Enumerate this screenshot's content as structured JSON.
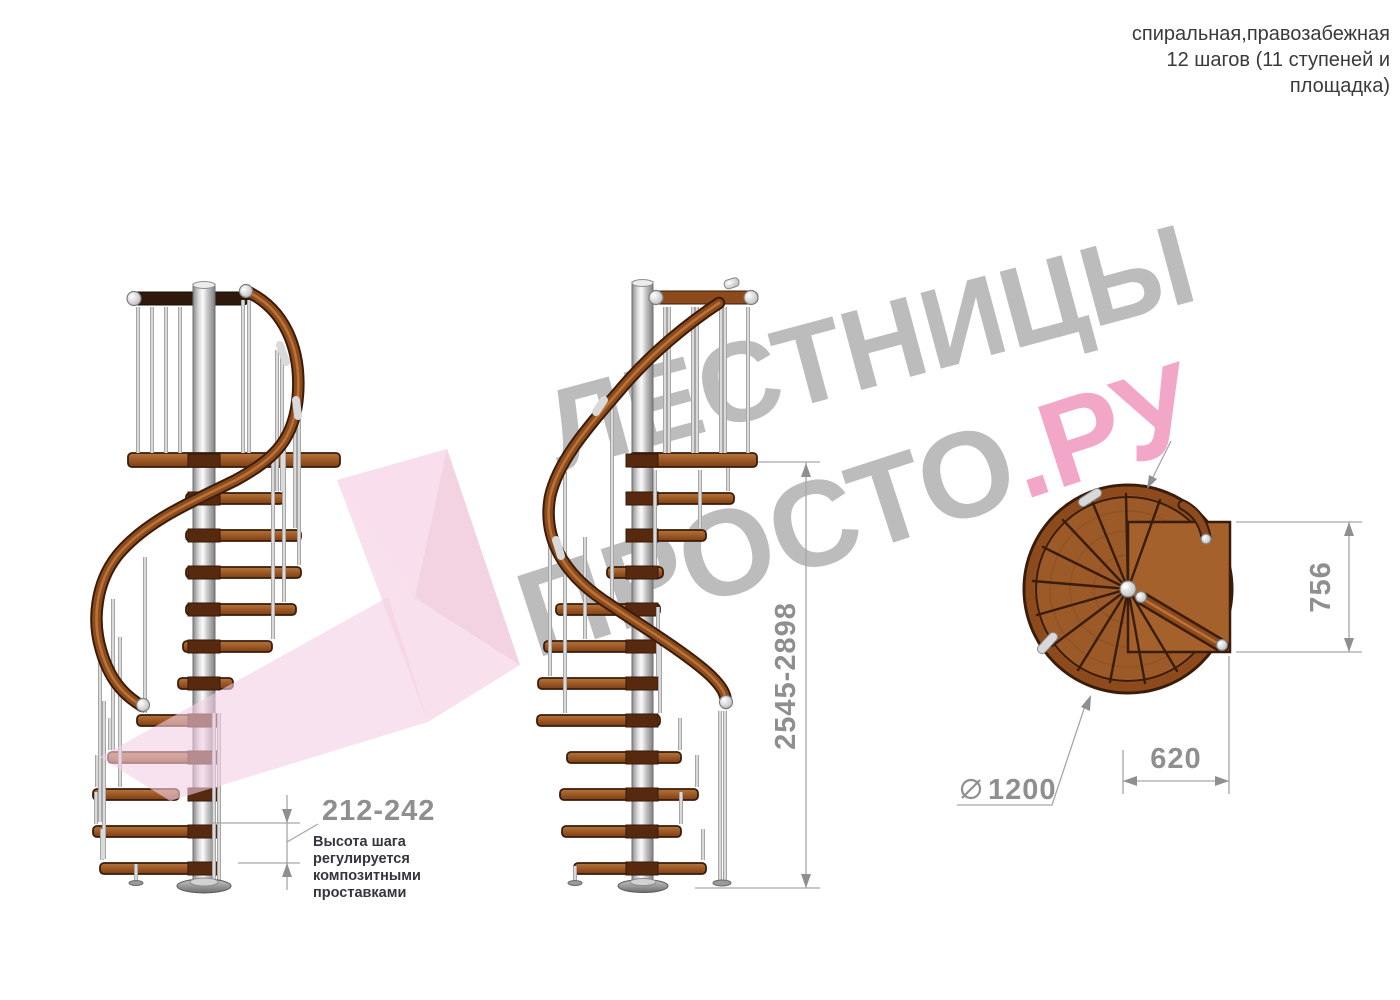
{
  "header": {
    "line1": "спиральная,правозабежная",
    "line2": "12 шагов (11 ступеней и",
    "line3": "площадка)"
  },
  "watermark": {
    "line1": "ЛЕСТНИЦЫ",
    "line2_gray": "ПРОСТО",
    "line2_pink": ".РУ"
  },
  "dimensions": {
    "step_height": {
      "value": "212-242",
      "note_line1": "Высота шага",
      "note_line2": "регулируется",
      "note_line3": "композитными",
      "note_line4": "проставками"
    },
    "total_height": {
      "value": "2545-2898"
    },
    "landing_depth": {
      "value": "756"
    },
    "landing_width": {
      "value": "620"
    },
    "diameter": {
      "value": "1200",
      "symbol": "diameter-sign"
    }
  },
  "colors": {
    "wood": "#9c5a28",
    "wood_dark": "#3a1c0a",
    "metal": "#d9d9d9",
    "dimension_text": "#8f8f8f",
    "watermark_gray": "#bcbcbc",
    "watermark_pink": "#f2a6c8",
    "arrow_pink": "#f3c9e0"
  }
}
